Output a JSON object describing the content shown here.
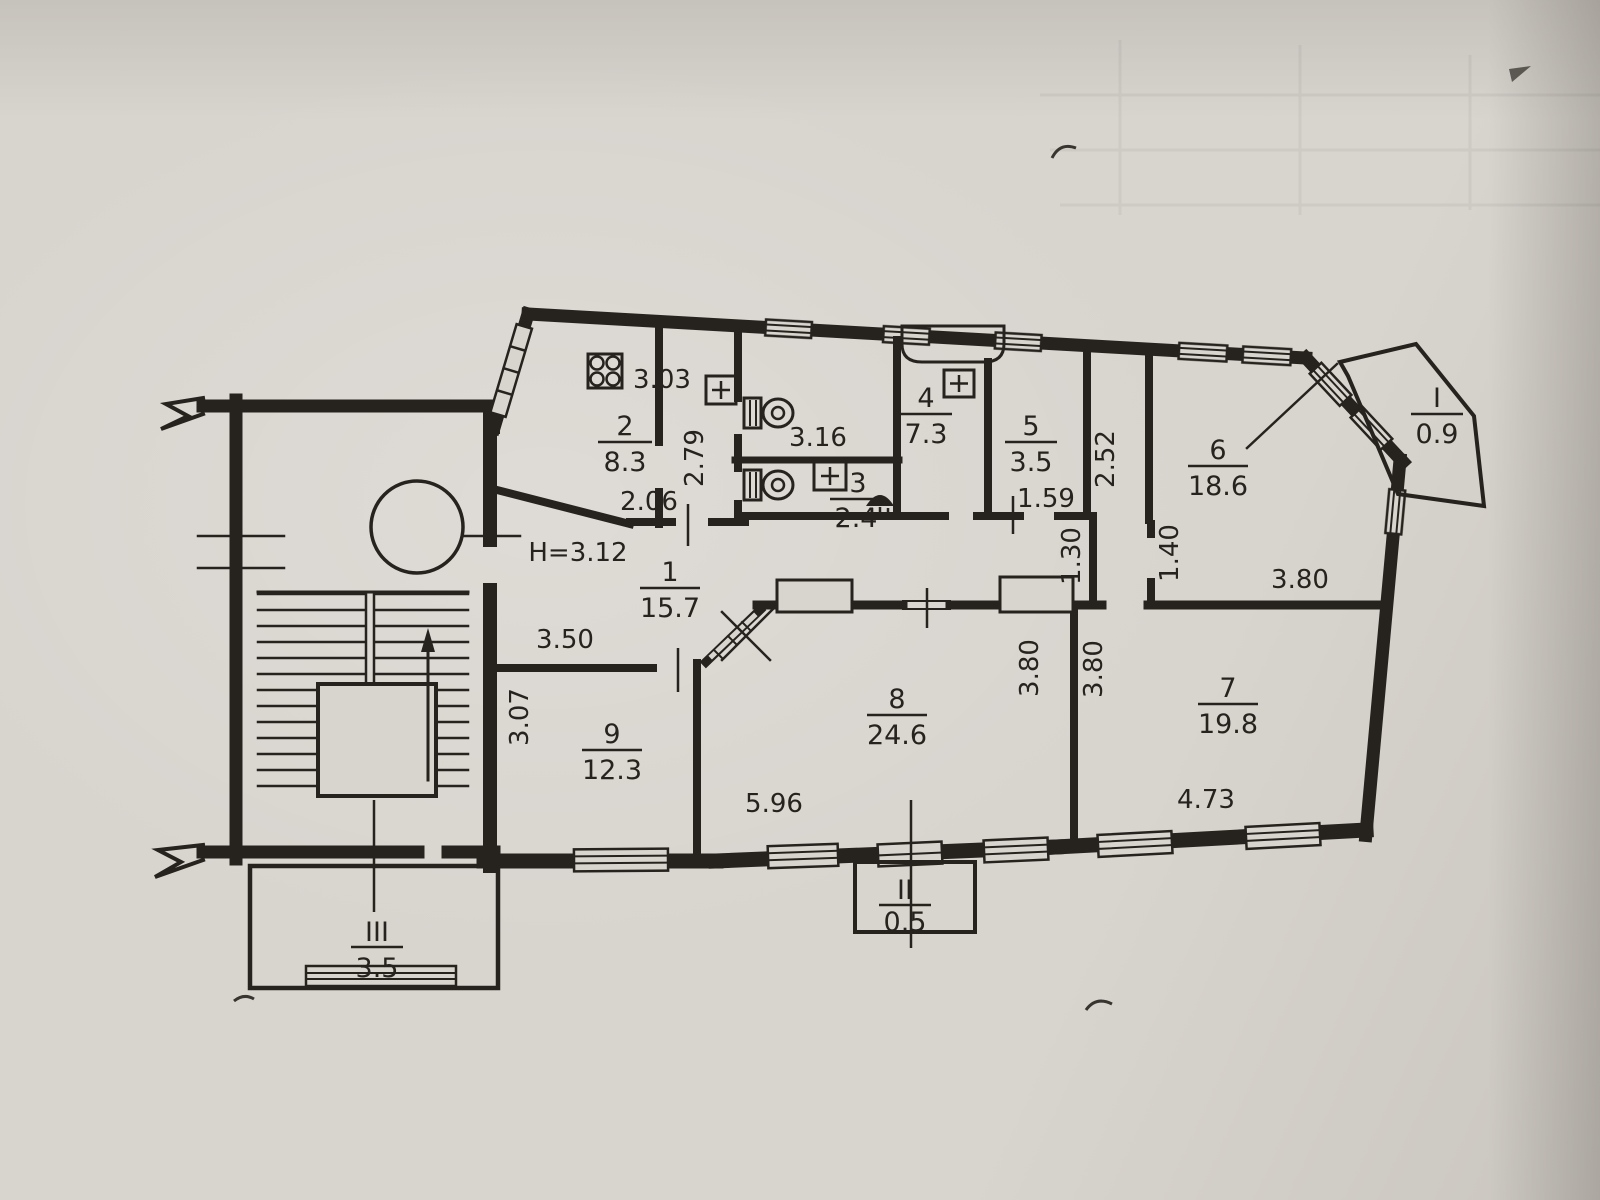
{
  "plan": {
    "ceiling_height": "H=3.12",
    "rooms": {
      "r1": {
        "number": "1",
        "area": "15.7"
      },
      "r2": {
        "number": "2",
        "area": "8.3"
      },
      "r3": {
        "number": "3",
        "area": "2.4"
      },
      "r4": {
        "number": "4",
        "area": "7.3"
      },
      "r5": {
        "number": "5",
        "area": "3.5"
      },
      "r6": {
        "number": "6",
        "area": "18.6"
      },
      "r7": {
        "number": "7",
        "area": "19.8"
      },
      "r8": {
        "number": "8",
        "area": "24.6"
      },
      "r9": {
        "number": "9",
        "area": "12.3"
      }
    },
    "balconies": {
      "b1": {
        "numeral": "I",
        "area": "0.9"
      },
      "b2": {
        "numeral": "II",
        "area": "0.5"
      },
      "b3": {
        "numeral": "III",
        "area": "3.5"
      }
    },
    "dims": {
      "stove": "3.03",
      "wc_width": "3.16",
      "corridor_height": "2.79",
      "kitchen_edge": "2.06",
      "closet_depth": "2.52",
      "wc5_width": "1.59",
      "nook_width": "1.30",
      "nook_depth": "1.40",
      "room6_bottom": "3.80",
      "room8_side": "3.80",
      "room7_side": "3.80",
      "room9_top": "3.50",
      "room9_side": "3.07",
      "room8_bottom": "5.96",
      "room7_bottom": "4.73"
    },
    "colors": {
      "paper": "#d8d4ce",
      "ink": "#26231f"
    }
  }
}
